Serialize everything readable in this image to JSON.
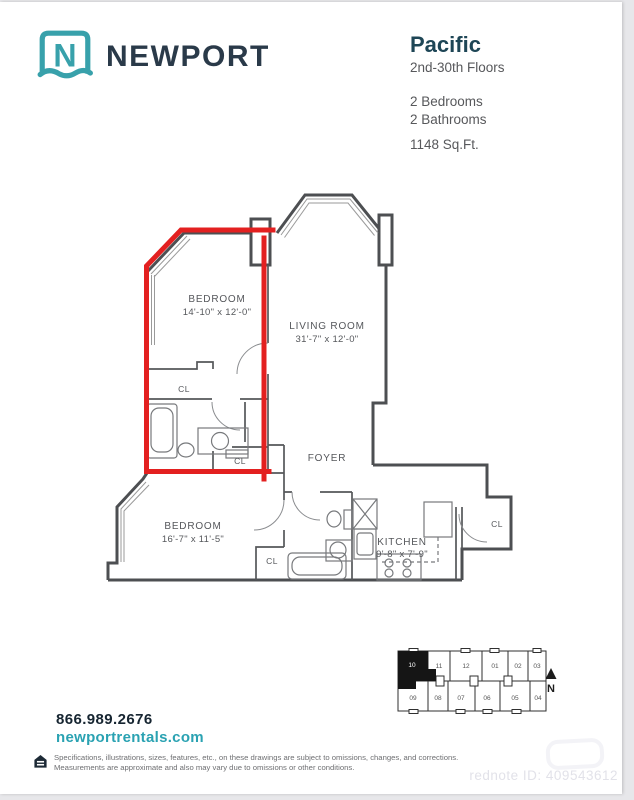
{
  "brand": {
    "name": "NEWPORT",
    "logo_letter": "N"
  },
  "header": {
    "plan_name": "Pacific",
    "floors": "2nd-30th Floors",
    "bedrooms": "2 Bedrooms",
    "bathrooms": "2 Bathrooms",
    "area": "1148 Sq.Ft."
  },
  "floor_plan": {
    "closet_label": "CL",
    "highlight_color": "#e32020",
    "rooms": [
      {
        "name": "BEDROOM",
        "dims": "14'-10\" x 12'-0\""
      },
      {
        "name": "LIVING ROOM",
        "dims": "31'-7\" x 12'-0\""
      },
      {
        "name": "FOYER",
        "dims": ""
      },
      {
        "name": "BEDROOM",
        "dims": "16'-7\" x 11'-5\""
      },
      {
        "name": "KITCHEN",
        "dims": "9'-8\" x 7'-9\""
      }
    ]
  },
  "key_plan": {
    "top_row": [
      "10",
      "11",
      "12",
      "01",
      "02",
      "03"
    ],
    "bottom_row": [
      "09",
      "08",
      "07",
      "06",
      "05",
      "04"
    ],
    "highlighted_unit": "10",
    "north_label": "N"
  },
  "footer": {
    "phone": "866.989.2676",
    "website": "newportrentals.com",
    "disclaimer_line1": "Specifications, illustrations, sizes, features, etc., on these drawings are subject to omissions, changes, and corrections.",
    "disclaimer_line2": "Measurements are approximate and also may vary due to omissions or other conditions.",
    "equal_housing_icon": "equal-housing-icon"
  },
  "watermark": {
    "text": "rednote ID: 409543612"
  },
  "colors": {
    "teal": "#38a1ab",
    "navy": "#2a3a49",
    "dark_teal": "#1e4656",
    "red": "#e32020",
    "wall": "#4d4f52"
  }
}
